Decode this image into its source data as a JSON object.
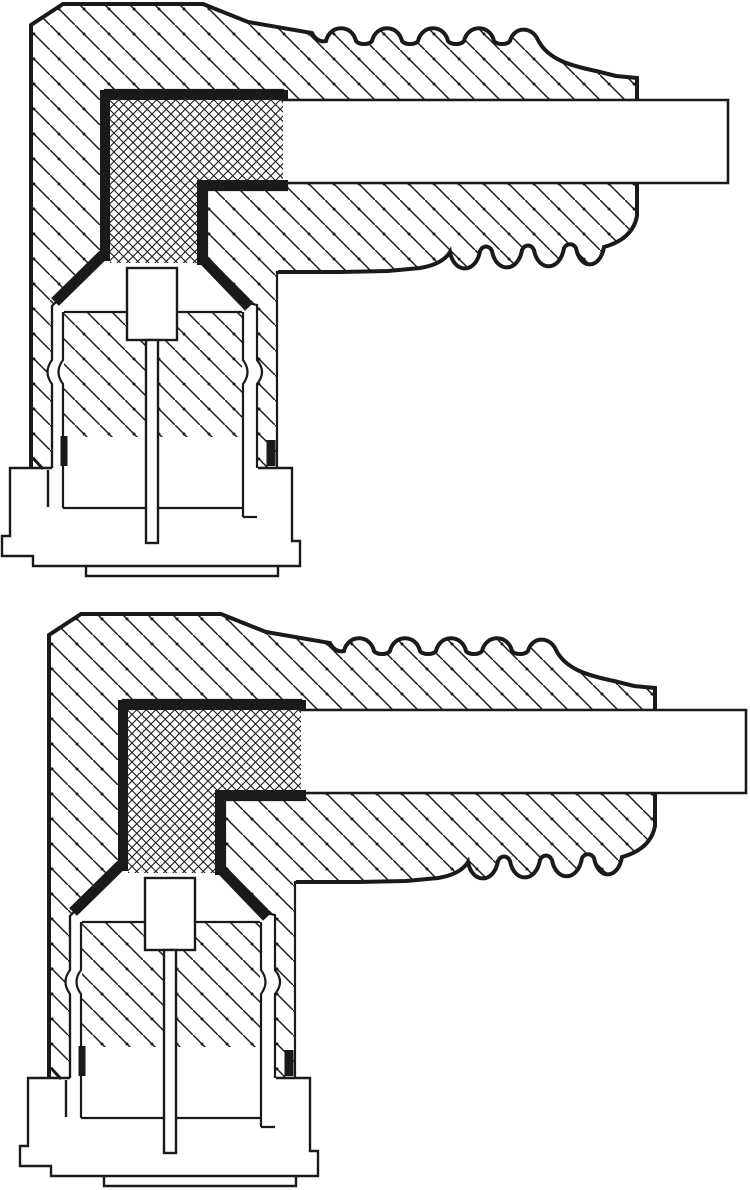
{
  "document": {
    "kind": "technical cross-section line drawing",
    "description": "Two right-angle coaxial connector cross-sections stacked vertically; scanned monochrome engineering illustration with no text labels",
    "text_content": ""
  },
  "colors": {
    "ink": "#1a1a1a",
    "paper": "#ffffff"
  },
  "figures": [
    {
      "id": "upper",
      "label": "right-angle connector cross-section, upper figure",
      "x": 0,
      "y": 0
    },
    {
      "id": "lower",
      "label": "right-angle connector cross-section, lower figure",
      "x": 18,
      "y": 610
    }
  ],
  "patterns": {
    "body_hatch": "45-degree diagonal section lines with dots, ~25px pitch",
    "insulator_hatch": "diamond crosshatch, ~9.5px pitch"
  },
  "parts": [
    "moulded body (diagonal hatch)",
    "insulator block (crosshatch)",
    "metal shell (thick black bands)",
    "cable entry (white rectangle)",
    "corrugated strain-relief boot",
    "socket tube with spring detents",
    "center contact block and pin",
    "stepped base flange"
  ]
}
